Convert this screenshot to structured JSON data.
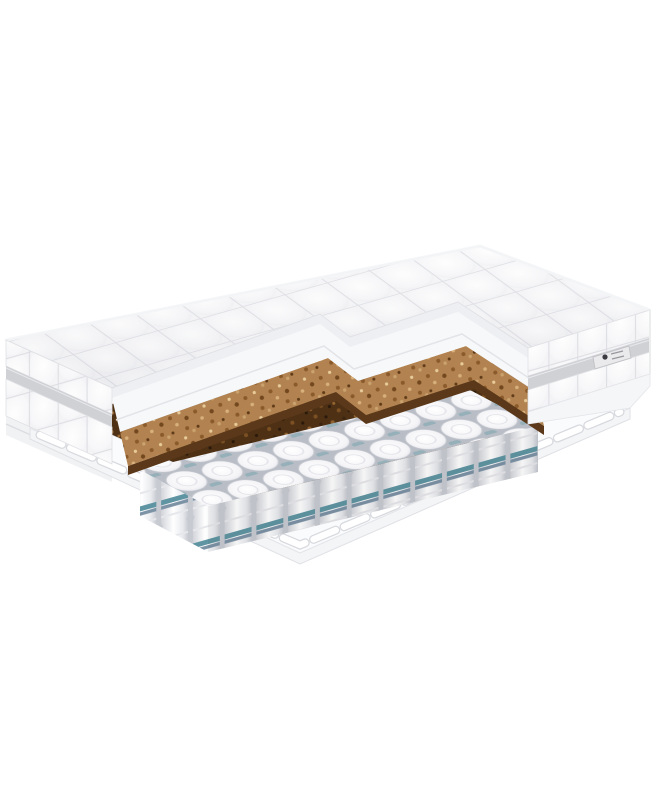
{
  "figure": {
    "aria_label": "Mattress cross-section product photo"
  },
  "icons": {
    "brand_logo": "diamond-mark"
  },
  "colors": {
    "background": "#ffffff",
    "quilt_white": "#f7f7f9",
    "quilt_seam": "#dfe0e5",
    "foam_white": "#f7f8fa",
    "coir_top": "#b28350",
    "coir_face": "#5a3819",
    "coir_dark": "#4e3115",
    "spring_fabric": "#ffffff",
    "spring_gap": "#b9bdc6",
    "stripe_teal": "#5f95a3",
    "stripe_steel": "#7c93a6",
    "tape_gray": "#d0d1d5",
    "label_bg": "#eaeaec",
    "label_glyph": "#3a3a40"
  }
}
